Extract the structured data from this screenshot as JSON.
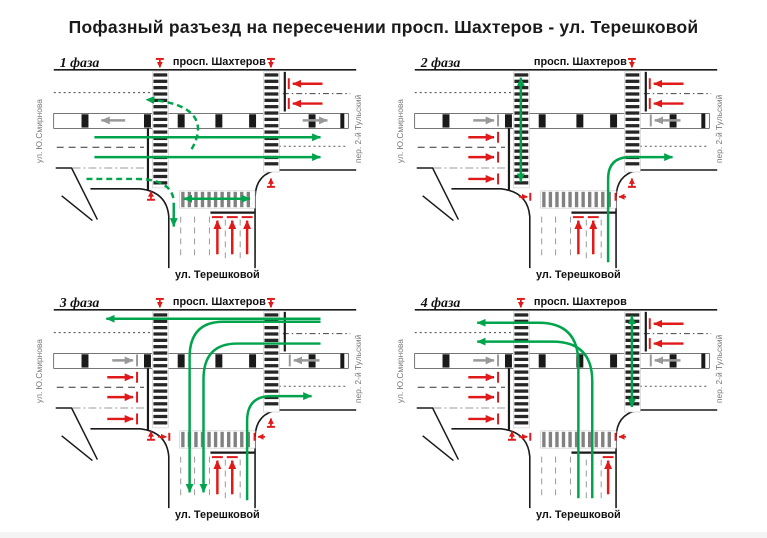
{
  "title": "Пофазный разъезд на пересечении просп. Шахтеров  - ул. Терешковой",
  "streets": {
    "top": "просп. Шахтеров",
    "bottom": "ул. Терешковой",
    "left": "ул. Ю.Смирнова",
    "right": "пер. 2-й Тульский"
  },
  "colors": {
    "green": "#00A44C",
    "red": "#E01A1A",
    "gray": "#999999",
    "road": "#1A1A1A",
    "label_gray": "#7A7A7A",
    "zebra_dark": "#262626",
    "zebra_gray": "#818181"
  },
  "panels": [
    {
      "label": "1 фаза",
      "arrows": [
        {
          "name": "green-through-eastbound-1",
          "color": "green",
          "d": "M 66,86 L 294,86",
          "head": "end"
        },
        {
          "name": "green-through-eastbound-2",
          "color": "green",
          "d": "M 66,106 L 294,106",
          "head": "end"
        },
        {
          "name": "green-uturn-to-westbound",
          "color": "green",
          "d": "M 164,98 C 178,74 172,51 118,48",
          "head": "end",
          "dash": "6,4"
        },
        {
          "name": "green-right-turn-west-to-south",
          "color": "green",
          "d": "M 58,128 L 108,128 Q 144,128 146,150",
          "head": "none",
          "dash": "6,4"
        },
        {
          "name": "green-right-turn-exit-south",
          "color": "green",
          "d": "M 146,152 L 146,176",
          "head": "end"
        },
        {
          "name": "green-ped-south-crosswalk",
          "color": "green",
          "d": "M 156,148 L 223,148",
          "head": "both"
        },
        {
          "name": "red-blocked-westbound-1",
          "color": "red",
          "d": "M 296,32 L 266,32",
          "head": "end",
          "bar": [
            262,
            26.5,
            262,
            37.5
          ]
        },
        {
          "name": "red-blocked-westbound-2",
          "color": "red",
          "d": "M 296,52 L 266,52",
          "head": "end",
          "bar": [
            262,
            46.5,
            262,
            57.5
          ]
        },
        {
          "name": "red-blocked-south-1",
          "color": "red",
          "d": "M 190,204 L 190,170",
          "head": "end",
          "bar": [
            184.5,
            166.5,
            195.5,
            166.5
          ]
        },
        {
          "name": "red-blocked-south-2",
          "color": "red",
          "d": "M 205,204 L 205,170",
          "head": "end",
          "bar": [
            199.5,
            166.5,
            210.5,
            166.5
          ]
        },
        {
          "name": "red-blocked-south-3",
          "color": "red",
          "d": "M 220,204 L 220,170",
          "head": "end",
          "bar": [
            214.5,
            166.5,
            225.5,
            166.5
          ]
        },
        {
          "name": "red-ped-west-crosswalk-north",
          "color": "red",
          "d": "M 132,8 L 132,15.5",
          "head": "end",
          "small": true,
          "bar": [
            128,
            7,
            136,
            7
          ]
        },
        {
          "name": "red-ped-east-crosswalk-north",
          "color": "red",
          "d": "M 244,8 L 244,15.5",
          "head": "end",
          "small": true,
          "bar": [
            240,
            7,
            248,
            7
          ]
        },
        {
          "name": "red-ped-west-crosswalk-south",
          "color": "red",
          "d": "M 123,148 L 123,140.5",
          "head": "end",
          "small": true,
          "bar": [
            119,
            149,
            127,
            149
          ]
        },
        {
          "name": "red-ped-east-crosswalk-south",
          "color": "red",
          "d": "M 244,135 L 244,127.5",
          "head": "end",
          "small": true,
          "bar": [
            240,
            136,
            248,
            136
          ]
        },
        {
          "name": "gray-tram-westbound",
          "color": "gray",
          "d": "M 97,69 L 73,69",
          "head": "end"
        },
        {
          "name": "gray-tram-eastbound",
          "color": "gray",
          "d": "M 276,69 L 301,69",
          "head": "end"
        }
      ]
    },
    {
      "label": "2 фаза",
      "arrows": [
        {
          "name": "green-ped-west-crosswalk",
          "color": "green",
          "d": "M 132,26 L 132,131",
          "head": "both"
        },
        {
          "name": "green-right-turn-south-to-east",
          "color": "green",
          "d": "M 220,212 L 220,128 Q 220,106 242,106 L 285,106",
          "head": "end"
        },
        {
          "name": "red-blocked-eastbound-1",
          "color": "red",
          "d": "M 79,86 L 105,86",
          "head": "end",
          "bar": [
            109,
            80.5,
            109,
            91.5
          ]
        },
        {
          "name": "red-blocked-eastbound-2",
          "color": "red",
          "d": "M 79,106 L 105,106",
          "head": "end",
          "bar": [
            109,
            100.5,
            109,
            111.5
          ]
        },
        {
          "name": "red-blocked-eastbound-3",
          "color": "red",
          "d": "M 79,128 L 105,128",
          "head": "end",
          "bar": [
            109,
            122.5,
            109,
            133.5
          ]
        },
        {
          "name": "red-blocked-westbound-1",
          "color": "red",
          "d": "M 296,32 L 266,32",
          "head": "end",
          "bar": [
            262,
            26.5,
            262,
            37.5
          ]
        },
        {
          "name": "red-blocked-westbound-2",
          "color": "red",
          "d": "M 296,52 L 266,52",
          "head": "end",
          "bar": [
            262,
            46.5,
            262,
            57.5
          ]
        },
        {
          "name": "red-blocked-south-1",
          "color": "red",
          "d": "M 190,204 L 190,170",
          "head": "end",
          "bar": [
            184.5,
            166.5,
            195.5,
            166.5
          ]
        },
        {
          "name": "red-blocked-south-2",
          "color": "red",
          "d": "M 205,204 L 205,170",
          "head": "end",
          "bar": [
            199.5,
            166.5,
            210.5,
            166.5
          ]
        },
        {
          "name": "red-ped-east-crosswalk-north",
          "color": "red",
          "d": "M 244,8 L 244,15.5",
          "head": "end",
          "small": true,
          "bar": [
            240,
            7,
            248,
            7
          ]
        },
        {
          "name": "red-ped-east-crosswalk-south",
          "color": "red",
          "d": "M 244,135 L 244,127.5",
          "head": "end",
          "small": true,
          "bar": [
            240,
            136,
            248,
            136
          ]
        },
        {
          "name": "red-ped-south-crosswalk-west",
          "color": "red",
          "d": "M 130,146 L 138.5,146",
          "head": "end",
          "small": true,
          "bar": [
            141.5,
            142,
            141.5,
            150
          ]
        },
        {
          "name": "red-ped-south-crosswalk-east",
          "color": "red",
          "d": "M 238,146 L 231,146",
          "head": "end",
          "small": true,
          "bar": [
            227.5,
            142,
            227.5,
            150
          ]
        },
        {
          "name": "gray-tram-eastbound-stopped",
          "color": "gray",
          "d": "M 84,69 L 105,69",
          "head": "end",
          "bar": [
            109,
            63,
            109,
            75
          ]
        },
        {
          "name": "gray-tram-westbound-stopped",
          "color": "gray",
          "d": "M 293,69 L 267,69",
          "head": "end",
          "bar": [
            263,
            63,
            263,
            75
          ]
        }
      ]
    },
    {
      "label": "3 фаза",
      "arrows": [
        {
          "name": "green-through-westbound",
          "color": "green",
          "d": "M 294,27 L 78,27",
          "head": "end"
        },
        {
          "name": "green-left-turn-west-to-south-1",
          "color": "green",
          "d": "M 294,30 L 196,30 Q 162,30 162,66 L 162,202",
          "head": "end"
        },
        {
          "name": "green-left-turn-west-to-south-2",
          "color": "green",
          "d": "M 294,52 L 210,52 Q 176,52 176,88 L 176,202",
          "head": "end"
        },
        {
          "name": "green-right-turn-south-to-east",
          "color": "green",
          "d": "M 220,210 L 220,130 Q 220,105 244,105 L 285,105",
          "head": "end"
        },
        {
          "name": "red-blocked-eastbound-1",
          "color": "red",
          "d": "M 79,86 L 105,86",
          "head": "end",
          "bar": [
            109,
            80.5,
            109,
            91.5
          ]
        },
        {
          "name": "red-blocked-eastbound-2",
          "color": "red",
          "d": "M 79,106 L 105,106",
          "head": "end",
          "bar": [
            109,
            100.5,
            109,
            111.5
          ]
        },
        {
          "name": "red-blocked-eastbound-3",
          "color": "red",
          "d": "M 79,128 L 105,128",
          "head": "end",
          "bar": [
            109,
            122.5,
            109,
            133.5
          ]
        },
        {
          "name": "red-blocked-south-1",
          "color": "red",
          "d": "M 190,204 L 190,170",
          "head": "end",
          "bar": [
            184.5,
            166.5,
            195.5,
            166.5
          ]
        },
        {
          "name": "red-blocked-south-2",
          "color": "red",
          "d": "M 205,204 L 205,170",
          "head": "end",
          "bar": [
            199.5,
            166.5,
            210.5,
            166.5
          ]
        },
        {
          "name": "red-ped-west-crosswalk-north",
          "color": "red",
          "d": "M 132,8 L 132,15.5",
          "head": "end",
          "small": true,
          "bar": [
            128,
            7,
            136,
            7
          ]
        },
        {
          "name": "red-ped-east-crosswalk-north",
          "color": "red",
          "d": "M 244,8 L 244,15.5",
          "head": "end",
          "small": true,
          "bar": [
            240,
            7,
            248,
            7
          ]
        },
        {
          "name": "red-ped-west-crosswalk-south",
          "color": "red",
          "d": "M 123,148 L 123,140.5",
          "head": "end",
          "small": true,
          "bar": [
            119,
            149,
            127,
            149
          ]
        },
        {
          "name": "red-ped-east-crosswalk-south",
          "color": "red",
          "d": "M 244,135 L 244,127.5",
          "head": "end",
          "small": true,
          "bar": [
            240,
            136,
            248,
            136
          ]
        },
        {
          "name": "red-ped-south-crosswalk-west",
          "color": "red",
          "d": "M 130,146 L 138.5,146",
          "head": "end",
          "small": true,
          "bar": [
            141.5,
            142,
            141.5,
            150
          ]
        },
        {
          "name": "red-ped-south-crosswalk-east",
          "color": "red",
          "d": "M 238,146 L 231,146",
          "head": "end",
          "small": true,
          "bar": [
            227.5,
            142,
            227.5,
            150
          ]
        },
        {
          "name": "gray-tram-eastbound-stopped",
          "color": "gray",
          "d": "M 84,69 L 105,69",
          "head": "end",
          "bar": [
            109,
            63,
            109,
            75
          ]
        },
        {
          "name": "gray-tram-westbound-stopped",
          "color": "gray",
          "d": "M 293,69 L 267,69",
          "head": "end",
          "bar": [
            263,
            63,
            263,
            75
          ]
        }
      ]
    },
    {
      "label": "4 фаза",
      "arrows": [
        {
          "name": "green-ped-east-crosswalk",
          "color": "green",
          "d": "M 244,24 L 244,116",
          "head": "both"
        },
        {
          "name": "green-left-turn-south-to-west-1",
          "color": "green",
          "d": "M 190,208 L 190,72 Q 190,31 150,31 L 88,31",
          "head": "end"
        },
        {
          "name": "green-left-turn-south-to-west-2",
          "color": "green",
          "d": "M 204,208 L 204,90 Q 204,50 164,50 L 88,50",
          "head": "end"
        },
        {
          "name": "red-blocked-eastbound-1",
          "color": "red",
          "d": "M 79,86 L 105,86",
          "head": "end",
          "bar": [
            109,
            80.5,
            109,
            91.5
          ]
        },
        {
          "name": "red-blocked-eastbound-2",
          "color": "red",
          "d": "M 79,106 L 105,106",
          "head": "end",
          "bar": [
            109,
            100.5,
            109,
            111.5
          ]
        },
        {
          "name": "red-blocked-eastbound-3",
          "color": "red",
          "d": "M 79,128 L 105,128",
          "head": "end",
          "bar": [
            109,
            122.5,
            109,
            133.5
          ]
        },
        {
          "name": "red-blocked-westbound-1",
          "color": "red",
          "d": "M 296,32 L 266,32",
          "head": "end",
          "bar": [
            262,
            26.5,
            262,
            37.5
          ]
        },
        {
          "name": "red-blocked-westbound-2",
          "color": "red",
          "d": "M 296,52 L 266,52",
          "head": "end",
          "bar": [
            262,
            46.5,
            262,
            57.5
          ]
        },
        {
          "name": "red-blocked-south-3",
          "color": "red",
          "d": "M 220,204 L 220,170",
          "head": "end",
          "bar": [
            214.5,
            166.5,
            225.5,
            166.5
          ]
        },
        {
          "name": "red-ped-west-crosswalk-north",
          "color": "red",
          "d": "M 132,8 L 132,15.5",
          "head": "end",
          "small": true,
          "bar": [
            128,
            7,
            136,
            7
          ]
        },
        {
          "name": "red-ped-west-crosswalk-south",
          "color": "red",
          "d": "M 123,148 L 123,140.5",
          "head": "end",
          "small": true,
          "bar": [
            119,
            149,
            127,
            149
          ]
        },
        {
          "name": "red-ped-south-crosswalk-west",
          "color": "red",
          "d": "M 130,146 L 138.5,146",
          "head": "end",
          "small": true,
          "bar": [
            141.5,
            142,
            141.5,
            150
          ]
        },
        {
          "name": "red-ped-south-crosswalk-east",
          "color": "red",
          "d": "M 238,146 L 231,146",
          "head": "end",
          "small": true,
          "bar": [
            227.5,
            142,
            227.5,
            150
          ]
        },
        {
          "name": "gray-tram-eastbound-stopped",
          "color": "gray",
          "d": "M 84,69 L 105,69",
          "head": "end",
          "bar": [
            109,
            63,
            109,
            75
          ]
        },
        {
          "name": "gray-tram-westbound-stopped",
          "color": "gray",
          "d": "M 293,69 L 267,69",
          "head": "end",
          "bar": [
            263,
            63,
            263,
            75
          ]
        }
      ]
    }
  ]
}
